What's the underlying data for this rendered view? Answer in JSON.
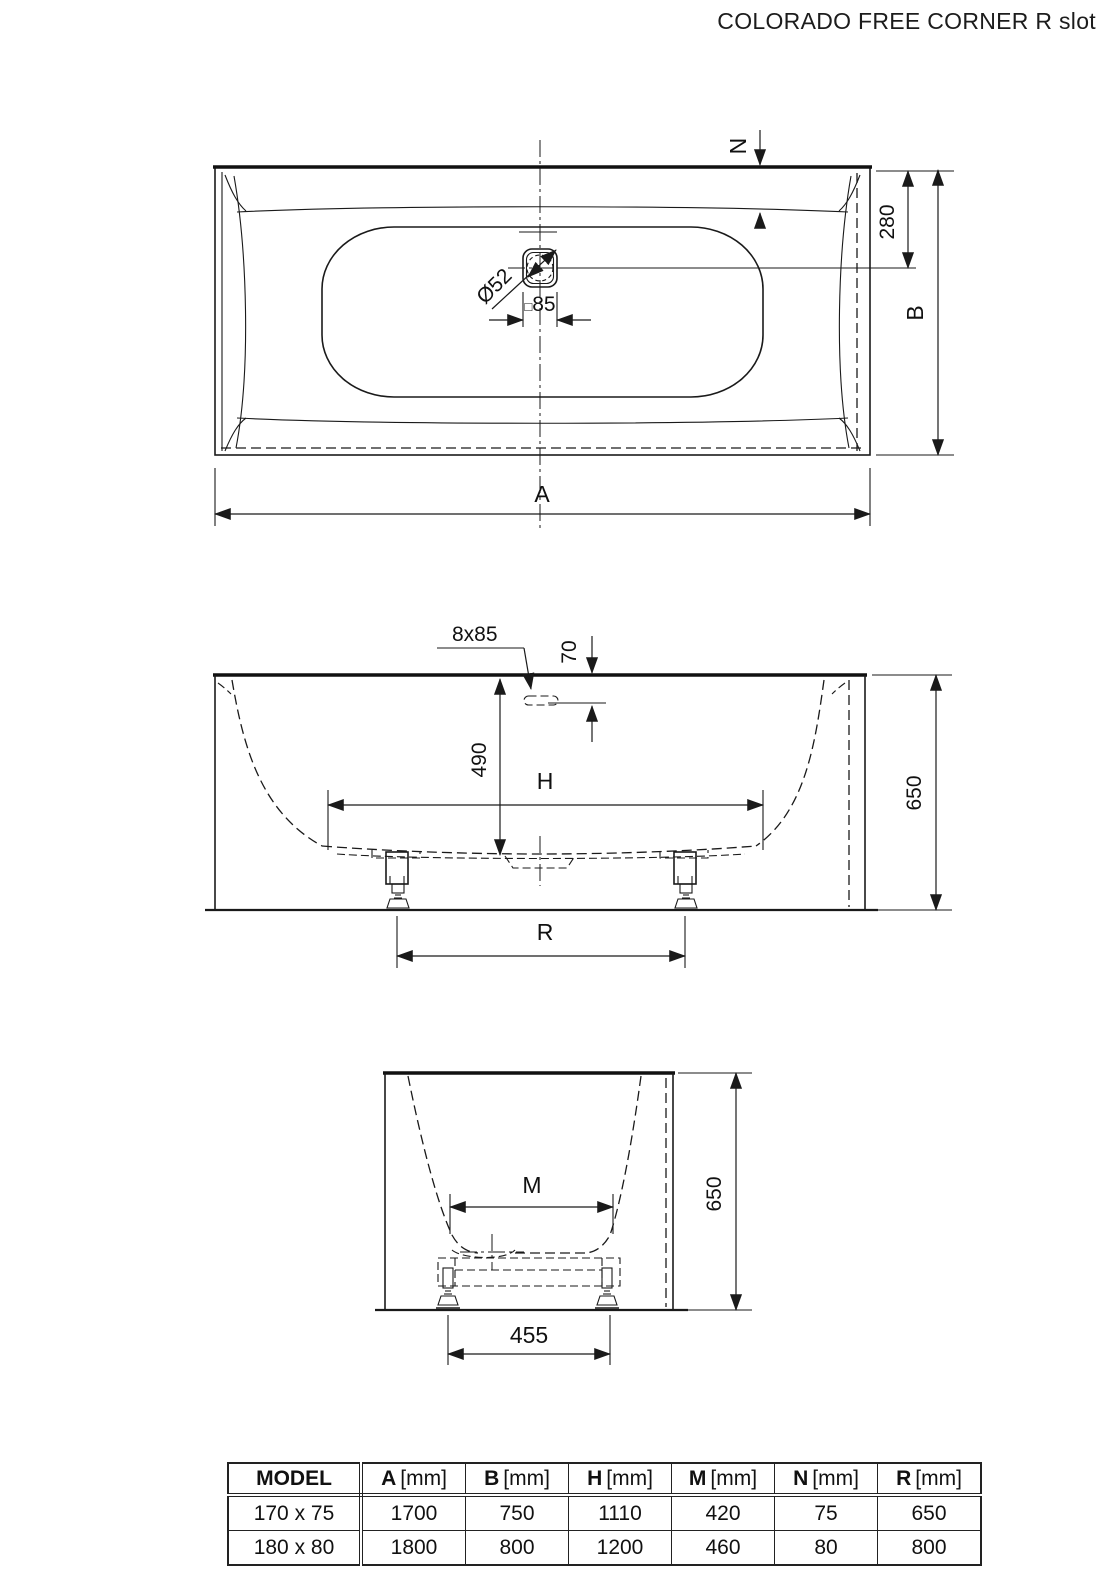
{
  "title": "COLORADO FREE CORNER R slot",
  "top_view": {
    "dim_n": "N",
    "dim_280": "280",
    "dim_b": "B",
    "dim_a": "A",
    "drain_diameter": "Ø52",
    "drain_square_symbol": "□",
    "drain_square_value": "85"
  },
  "side_view": {
    "slot_label": "8x85",
    "dim_70": "70",
    "dim_490": "490",
    "dim_h": "H",
    "dim_650": "650",
    "dim_r": "R"
  },
  "end_view": {
    "dim_m": "M",
    "dim_650": "650",
    "dim_455": "455"
  },
  "table": {
    "headers": [
      {
        "key": "MODEL",
        "unit": ""
      },
      {
        "key": "A",
        "unit": "[mm]"
      },
      {
        "key": "B",
        "unit": "[mm]"
      },
      {
        "key": "H",
        "unit": "[mm]"
      },
      {
        "key": "M",
        "unit": "[mm]"
      },
      {
        "key": "N",
        "unit": "[mm]"
      },
      {
        "key": "R",
        "unit": "[mm]"
      }
    ],
    "rows": [
      {
        "model": "170 x 75",
        "a": "1700",
        "b": "750",
        "h": "1110",
        "m": "420",
        "n": "75",
        "r": "650"
      },
      {
        "model": "180 x 80",
        "a": "1800",
        "b": "800",
        "h": "1200",
        "m": "460",
        "n": "80",
        "r": "800"
      }
    ]
  }
}
